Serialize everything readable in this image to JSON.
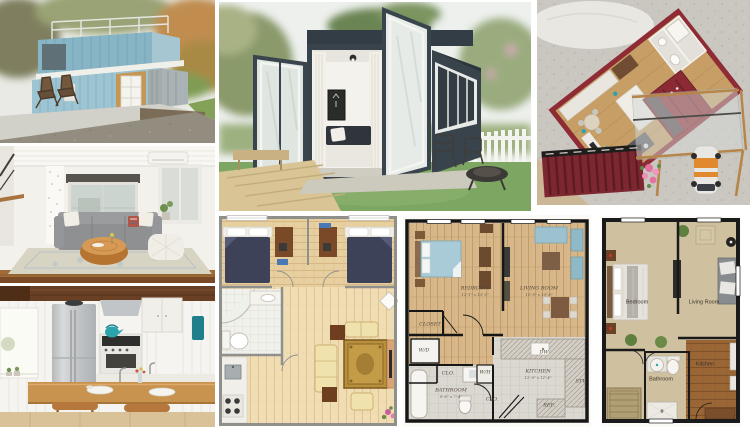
{
  "page": {
    "background": "#ffffff",
    "description": "Collage of shipping-container tiny homes: exterior photos, interiors, a scale model and three apartment floor plans"
  },
  "colors": {
    "container_blue": "#9cc4d2",
    "container_slate": "#39434c",
    "container_red": "#8e2b34",
    "lawn_green": "#7da662",
    "plan_wood": "#d9ba8c",
    "plan_tan": "#cfc0a0"
  },
  "tiles": {
    "blue_house": {
      "alt": "Two-story light blue shipping container house with roof deck"
    },
    "living_room": {
      "alt": "Tiny home living room with gray sofa, stump coffee table and pouf"
    },
    "kitchen": {
      "alt": "Tiny home kitchen with breakfast bar, stools and fridge"
    },
    "open_container": {
      "alt": "Slate container cabin with folding glass doors open to a lawn"
    },
    "model": {
      "alt": "Miniature scale model of a red container home interior"
    },
    "plan_color": {
      "alt": "Rendered floor plan with two bedrooms, bathroom, kitchen and living room"
    },
    "plan_labeled": {
      "alt": "One-bedroom apartment floor plan with room dimensions",
      "labels": {
        "bedroom": "BEDROOM",
        "bedroom_dim": "12'-1\" x 13'-3\"",
        "living": "LIVING ROOM",
        "living_dim": "12'-9\" x 13'-8\"",
        "closet": "CLOSET",
        "wd": "W/D",
        "clo1": "CLO.",
        "bathroom": "BATHROOM",
        "bathroom_dim": "9'-6\" x 7'-4\"",
        "wh": "W/H",
        "clo2": "CLO.",
        "kitchen": "KITCHEN",
        "kitchen_dim": "12'-9\" x 11'-4\"",
        "dw": "DW",
        "stv": "STV.",
        "ref": "REF."
      }
    },
    "plan_tan": {
      "alt": "One-bedroom floor plan in tan rendering",
      "labels": {
        "bedroom": "Bedroom",
        "living": "Living Room",
        "bathroom": "Bathroom",
        "kitchen": "Kitchen"
      }
    }
  }
}
